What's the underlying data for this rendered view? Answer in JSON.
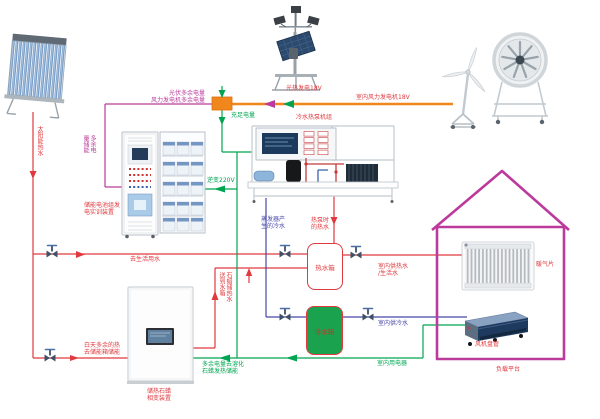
{
  "colors": {
    "hot_water_line": "#e0393e",
    "cold_water_line": "#4747ab",
    "electricity_line": "#00a551",
    "wind_pv_bus": "#f0861c",
    "excess_power_line": "#bb3a9c",
    "house_outline": "#bb3a9c",
    "cold_tank_fill": "#1aa24f"
  },
  "labels": {
    "solar_hot_water": "太阳能热水",
    "excess_storage_vert": "多余电量储能",
    "pv_wind_excess": "光伏多余电量\n风力发电机多余电量",
    "battery_device": "储能电池组发电实训装置",
    "pv_generation": "光热发电18V",
    "wind_generation": "室内风力发电机18V",
    "sufficient_power": "充足电量",
    "inverter_220v": "逆变220V",
    "heat_pump_unit": "冷水热泵机组",
    "evaporator_cold_water": "蒸发器产生的冷水",
    "heat_pump_hot_water": "热泵时的热水",
    "to_domestic_water": "去生活用水",
    "hot_water_tank": "热水箱",
    "cold_water_tank": "冷水箱",
    "indoor_hot_water": "室内供热水\n/生活水",
    "indoor_cold_water": "室内供冷水",
    "indoor_appliances": "室内用电器",
    "day_excess_heat": "白天多余的热去储能箱储能",
    "paraffin_hot_to_tank": "石蜡储热水送到水箱",
    "paraffin_device": "储热石蜡相变装置",
    "excess_melt_paraffin": "多余电量去溶化石蜡发热储能",
    "radiator": "暖气片",
    "fan_coil": "风机盘管",
    "load_platform": "负载平台"
  }
}
